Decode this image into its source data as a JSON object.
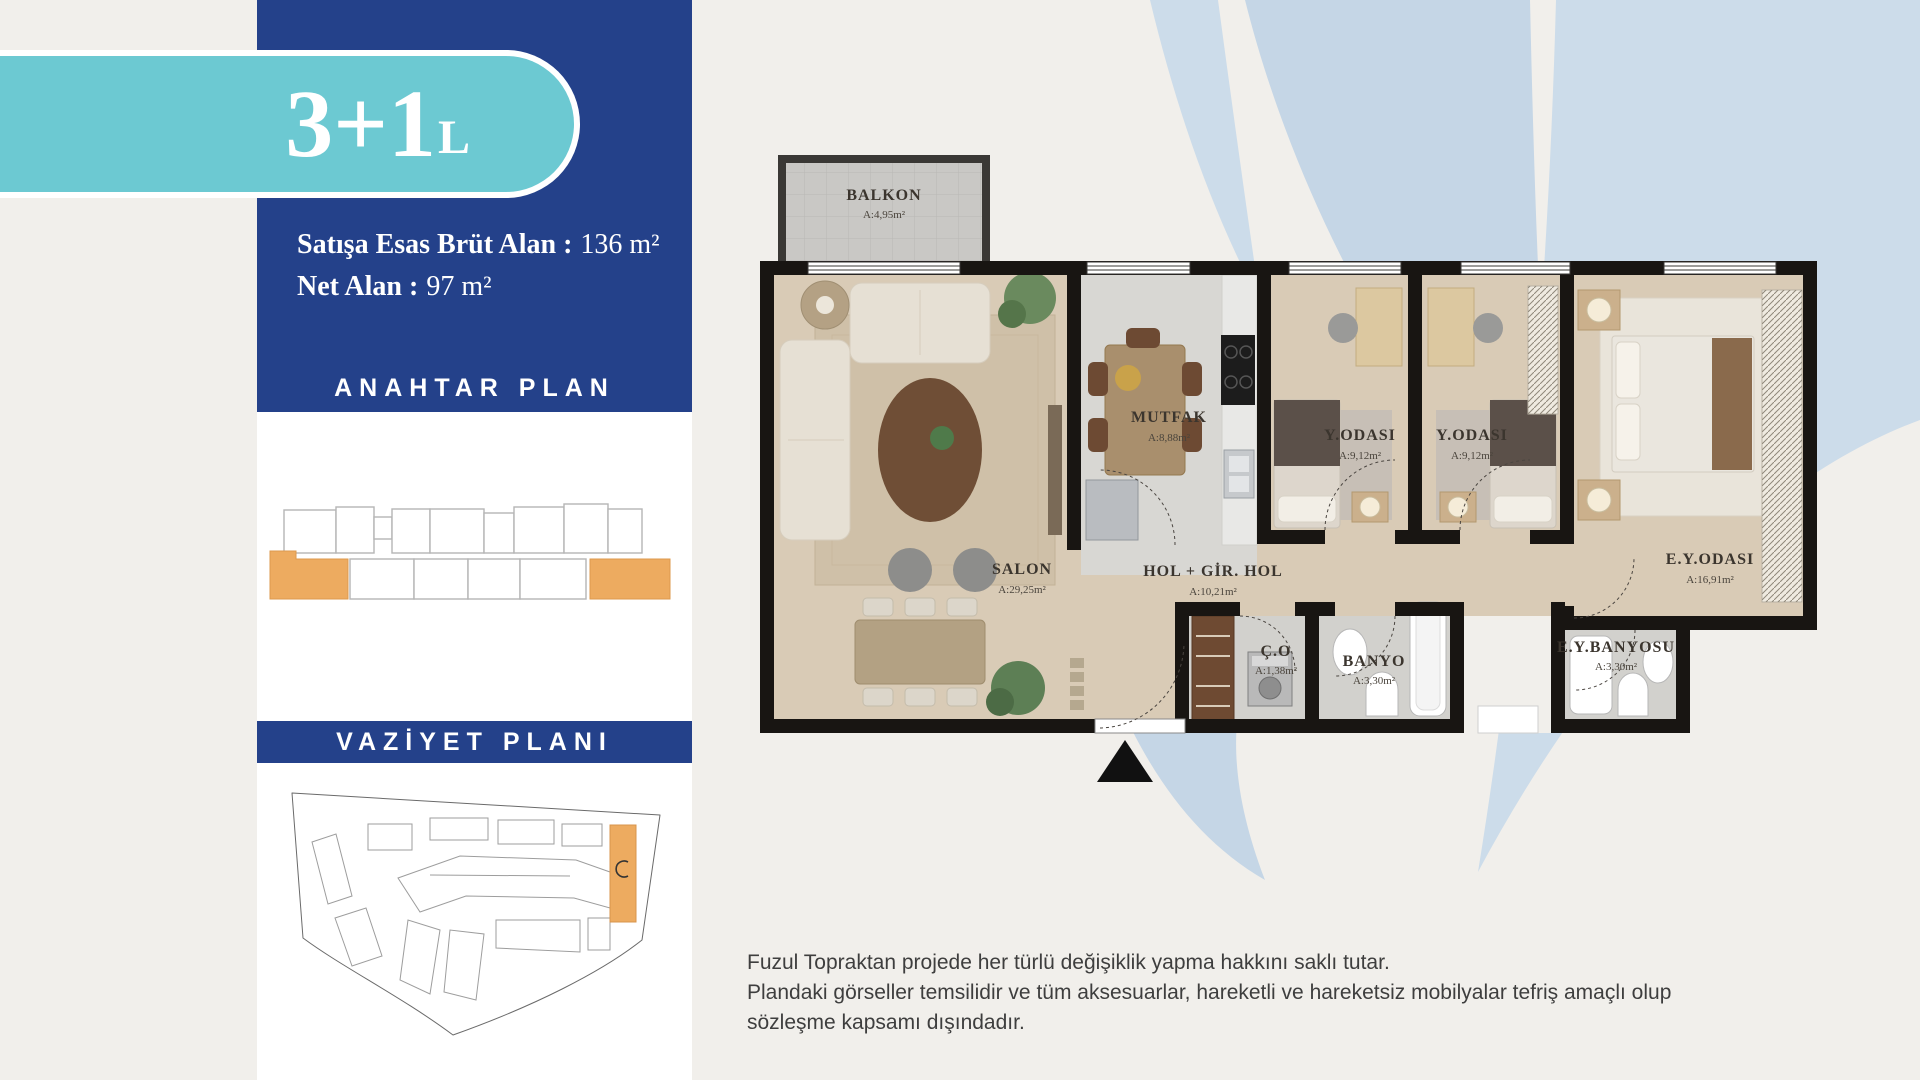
{
  "badge": {
    "main": "3+1",
    "suffix": "L"
  },
  "info": {
    "gross_label": "Satışa Esas Brüt Alan :",
    "gross_value": "136 m²",
    "net_label": "Net Alan :",
    "net_value": "97 m²"
  },
  "sections": {
    "key_plan_title": "ANAHTAR PLAN",
    "site_plan_title": "VAZİYET PLANI"
  },
  "floor_plan": {
    "rooms": [
      {
        "id": "balkon",
        "name": "BALKON",
        "area": "A:4,95m²"
      },
      {
        "id": "salon",
        "name": "SALON",
        "area": "A:29,25m²"
      },
      {
        "id": "mutfak",
        "name": "MUTFAK",
        "area": "A:8,88m²"
      },
      {
        "id": "hol",
        "name": "HOL + GİR. HOL",
        "area": "A:10,21m²"
      },
      {
        "id": "y_odasi_1",
        "name": "Y.ODASI",
        "area": "A:9,12m²"
      },
      {
        "id": "y_odasi_2",
        "name": "Y.ODASI",
        "area": "A:9,12m²"
      },
      {
        "id": "ey_odasi",
        "name": "E.Y.ODASI",
        "area": "A:16,91m²"
      },
      {
        "id": "co",
        "name": "Ç.O",
        "area": "A:1,38m²"
      },
      {
        "id": "banyo",
        "name": "BANYO",
        "area": "A:3,30m²"
      },
      {
        "id": "ey_banyosu",
        "name": "E.Y.BANYOSU",
        "area": "A:3,30m²"
      }
    ]
  },
  "disclaimer": {
    "line1": "Fuzul Topraktan projede her türlü değişiklik yapma hakkını saklı tutar.",
    "line2": "Plandaki görseller temsilidir ve tüm aksesuarlar, hareketli ve hareketsiz mobilyalar tefriş amaçlı olup sözleşme kapsamı dışındadır."
  },
  "colors": {
    "accent_blue": "#24418a",
    "accent_teal": "#6cc9d2",
    "highlight_orange": "#edab60",
    "swoosh_blue": "#ccdcea",
    "background": "#f1efeb",
    "wall_black": "#181512",
    "floor_beige": "#d9cbb6",
    "tile_gray": "#d8d7d3"
  }
}
